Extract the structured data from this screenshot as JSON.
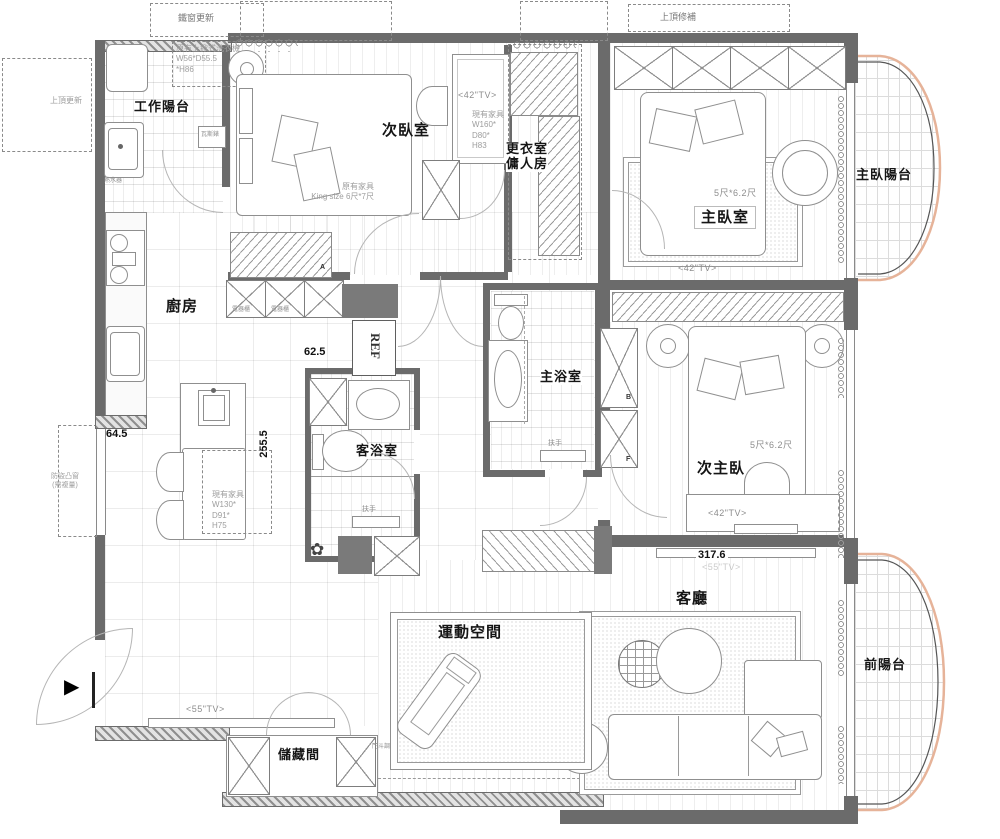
{
  "rooms": {
    "work_balcony": "工作陽台",
    "secondary_bedroom": "次臥室",
    "closet_maid": "更衣室\n傭人房",
    "master_bedroom": "主臥室",
    "master_balcony": "主臥陽台",
    "kitchen": "廚房",
    "master_bath": "主浴室",
    "guest_bath": "客浴室",
    "second_master": "次主臥",
    "living_room": "客廳",
    "exercise": "運動空間",
    "front_balcony": "前陽台",
    "storage": "儲藏間"
  },
  "notes": {
    "iron_window": "鐵窗更新",
    "ceiling_update": "上頂更新",
    "ceiling_repair": "上頂修補",
    "washer": "原有上掀式洗衣機\nW56*D55.5\n*H86",
    "water_heater": "熱水器",
    "gas_meter": "瓦斯錶",
    "king_bed": "原有家具\nKing size 6尺*7尺",
    "wardrobe_160": "現有家具\nW160*\nD80*\nH83",
    "dining_set": "現有家具\nW130*\nD91*\nH75",
    "bed_size_master": "5尺*6.2尺",
    "bed_size_second": "5尺*6.2尺",
    "tv42_bed2": "<42\"TV>",
    "tv42_master": "<42\"TV>",
    "tv42_second": "<42\"TV>",
    "tv55_dining": "<55\"TV>",
    "tv55_living": "<55\"TV>",
    "appliance_cabinet_1": "電器櫃",
    "appliance_cabinet_2": "電器櫃",
    "handrail_guest": "扶手",
    "handrail_master": "扶手",
    "ref": "REF",
    "bay_window_note": "防盜凸窗\n(需複量)",
    "door_note": "門斗調整",
    "marker_a": "A",
    "marker_b": "B",
    "marker_f": "F"
  },
  "dimensions": {
    "kitchen_gap": "62.5",
    "counter_end": "64.5",
    "hall_depth": "255.5",
    "tv_wall": "317.6"
  },
  "colors": {
    "wall": "#6b6b6b",
    "balcony_outline": "#e6b399"
  }
}
